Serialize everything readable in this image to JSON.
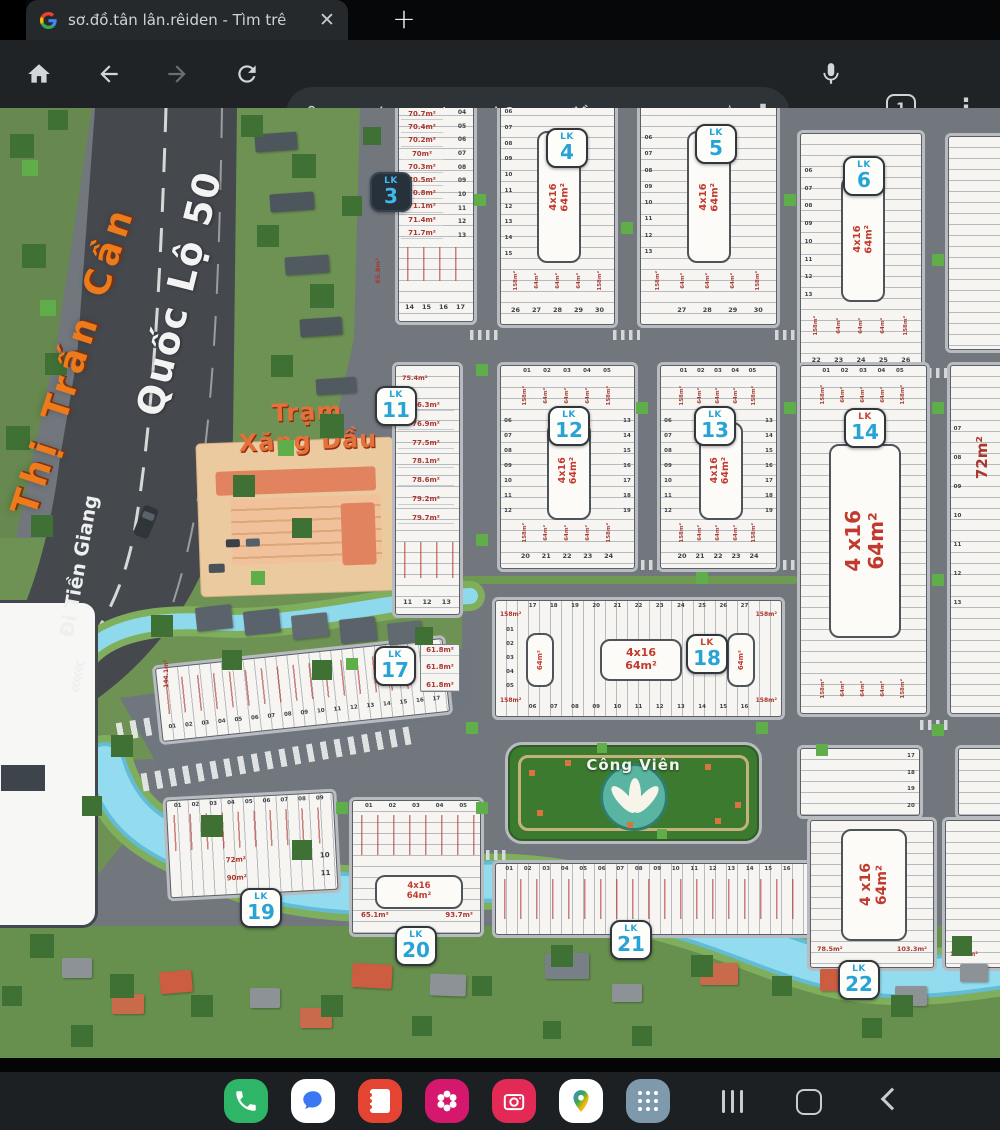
{
  "browser": {
    "tab_title": "sơ.đồ.tân lân.rêiden - Tìm trê",
    "close_label": "✕",
    "new_tab_label": "+",
    "url": "google.com/search?q=sơ.đồ",
    "star_label": "☆",
    "tab_count": "1",
    "menu_label": "⋮"
  },
  "map": {
    "town_label": "Thị Trấn Cần",
    "highway_name": "Quốc Lộ 50",
    "direction_label": "Đi Tiền Giang",
    "direction_chevrons": "«««",
    "gas_station_line1": "Trạm",
    "gas_station_line2": "Xăng Dầu",
    "park_name": "Công Viên",
    "lk_prefix": "LK",
    "unit_label": "4x16",
    "unit_area": "64m²",
    "big_unit_label": "4 x16",
    "face_areas": [
      "158m²",
      "64m²",
      "64m²",
      "64m²",
      "158m²"
    ],
    "mini": {
      "a158": "158m²",
      "a64": "64m²"
    },
    "blocks": {
      "lk3": {
        "num": "3",
        "areas": [
          "70.7m²",
          "70.4m²",
          "70.2m²",
          "70m²",
          "70.3m²",
          "70.5m²",
          "70.8m²",
          "71.1m²",
          "71.4m²",
          "71.7m²"
        ],
        "plot_nums": [
          "04",
          "05",
          "06",
          "07",
          "08",
          "09",
          "10",
          "11",
          "12",
          "13"
        ],
        "bottom_nums": [
          "14",
          "15",
          "16",
          "17"
        ],
        "left_area": "65.8m²"
      },
      "lk4": {
        "num": "4",
        "side_nums": [
          "06",
          "07",
          "08",
          "09",
          "10",
          "11",
          "12",
          "13",
          "14",
          "15"
        ],
        "bottom_nums": [
          "26",
          "27",
          "28",
          "29",
          "30"
        ]
      },
      "lk5": {
        "num": "5",
        "side_nums": [
          "06",
          "07",
          "08",
          "09",
          "10",
          "11",
          "12",
          "13"
        ],
        "bottom_nums": [
          "27",
          "28",
          "29",
          "30"
        ]
      },
      "lk6": {
        "num": "6",
        "side_nums": [
          "06",
          "07",
          "08",
          "09",
          "10",
          "11",
          "12",
          "13"
        ],
        "bottom_nums": [
          "22",
          "23",
          "24",
          "25",
          "26"
        ]
      },
      "lk11": {
        "num": "11",
        "top_area": "75.4m²",
        "areas": [
          "76.3m²",
          "76.9m²",
          "77.5m²",
          "78.1m²",
          "78.6m²",
          "79.2m²",
          "79.7m²"
        ],
        "bottom_nums": [
          "11",
          "12",
          "13"
        ]
      },
      "lk12": {
        "num": "12",
        "top_nums": [
          "01",
          "02",
          "03",
          "04",
          "05"
        ],
        "left_nums": [
          "06",
          "07",
          "08",
          "09",
          "10",
          "11",
          "12"
        ],
        "right_nums": [
          "13",
          "14",
          "15",
          "16",
          "17",
          "18",
          "19"
        ],
        "bottom_nums": [
          "20",
          "21",
          "22",
          "23",
          "24"
        ]
      },
      "lk13": {
        "num": "13",
        "top_nums": [
          "01",
          "02",
          "03",
          "04",
          "05"
        ],
        "left_nums": [
          "06",
          "07",
          "08",
          "09",
          "10",
          "11",
          "12"
        ],
        "right_nums": [
          "13",
          "14",
          "15",
          "16",
          "17",
          "18",
          "19"
        ],
        "bottom_nums": [
          "20",
          "21",
          "22",
          "23",
          "24"
        ]
      },
      "lk14": {
        "num": "14",
        "top_nums": [
          "01",
          "02",
          "03",
          "04",
          "05"
        ]
      },
      "lk17": {
        "num": "17",
        "plot_nums": [
          "01",
          "02",
          "03",
          "04",
          "05",
          "06",
          "07",
          "08",
          "09",
          "10",
          "11",
          "12",
          "13",
          "14",
          "15",
          "16",
          "17"
        ],
        "side_areas": [
          "61.8m²",
          "61.8m²",
          "61.8m²"
        ],
        "left_area": "144.1m²"
      },
      "lk18": {
        "num": "18",
        "top_nums": [
          "17",
          "18",
          "19",
          "20",
          "21",
          "22",
          "23",
          "24",
          "25",
          "26",
          "27"
        ],
        "bottom_nums": [
          "06",
          "07",
          "08",
          "09",
          "10",
          "11",
          "12",
          "13",
          "14",
          "15",
          "16"
        ],
        "left_nums": [
          "01",
          "02",
          "03",
          "04",
          "05"
        ]
      },
      "lk19": {
        "num": "19",
        "top_nums": [
          "01",
          "02",
          "03",
          "04",
          "05",
          "06",
          "07",
          "08",
          "09"
        ],
        "row_areas": [
          "72m²",
          "90m²"
        ],
        "row_nums": [
          "10",
          "11"
        ]
      },
      "lk20": {
        "num": "20",
        "top_nums": [
          "01",
          "02",
          "03",
          "04",
          "05"
        ],
        "areas": [
          "65.1m²",
          "93.7m²"
        ]
      },
      "lk21": {
        "num": "21",
        "plot_nums": [
          "01",
          "02",
          "03",
          "04",
          "05",
          "06",
          "07",
          "08",
          "09",
          "10",
          "11",
          "12",
          "13",
          "14",
          "15",
          "16"
        ],
        "right_area": "148.3m²"
      },
      "lk22": {
        "num": "22",
        "areas": [
          "78.5m²",
          "103.3m²"
        ]
      },
      "r2": {
        "area_big": "72m²",
        "side_nums": [
          "07",
          "08",
          "09",
          "10",
          "11",
          "12",
          "13"
        ]
      },
      "r3": {
        "side_nums": [
          "17",
          "18",
          "19",
          "20"
        ]
      },
      "r4": {
        "area": "111.4m²"
      }
    }
  },
  "navbar": {
    "app_icons": [
      "phone",
      "messages",
      "contacts",
      "gallery",
      "camera",
      "maps",
      "app-drawer"
    ],
    "nav_buttons": [
      "recents",
      "home",
      "back"
    ]
  }
}
